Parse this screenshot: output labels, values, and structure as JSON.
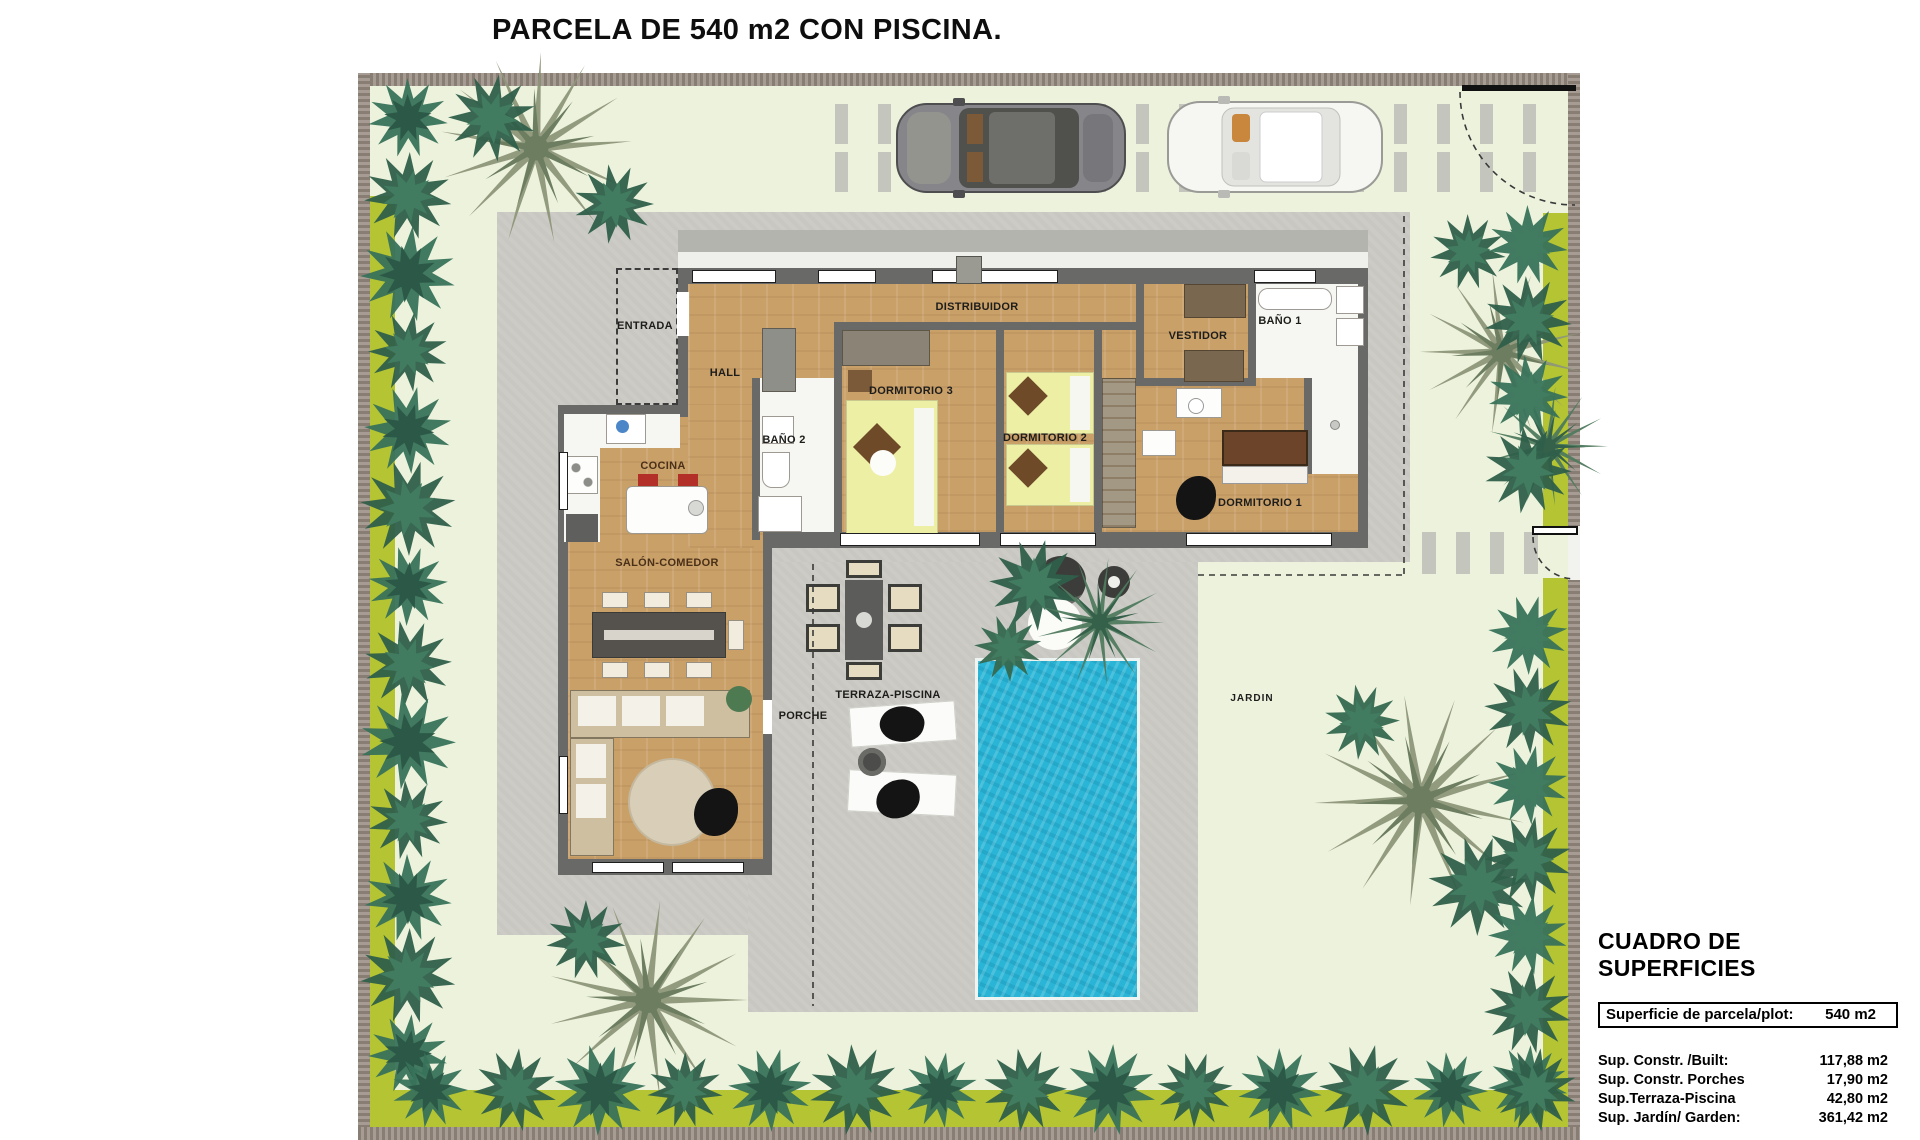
{
  "title": "PARCELA DE 540 m2 CON PISCINA.",
  "rooms": {
    "entrada": "ENTRADA",
    "hall": "HALL",
    "distribuidor": "DISTRIBUIDOR",
    "bano2": "BAÑO 2",
    "dormitorio3": "DORMITORIO 3",
    "dormitorio2": "DORMITORIO 2",
    "dormitorio1": "DORMITORIO 1",
    "vestidor": "VESTIDOR",
    "bano1": "BAÑO 1",
    "cocina": "COCINA",
    "salon": "SALÓN-COMEDOR",
    "porche": "PORCHE",
    "terraza": "TERRAZA-PISCINA",
    "jardin": "JARDIN"
  },
  "summary": {
    "heading": "CUADRO DE SUPERFICIES",
    "plot_row": {
      "label": "Superficie de parcela/plot:",
      "value": "540 m2"
    },
    "rows": [
      {
        "label": "Sup. Constr. /Built:",
        "value": "117,88 m2"
      },
      {
        "label": "Sup. Constr. Porches",
        "value": "17,90 m2"
      },
      {
        "label": "Sup.Terraza-Piscina",
        "value": "42,80 m2"
      },
      {
        "label": "Sup. Jardín/ Garden:",
        "value": "361,42 m2"
      }
    ],
    "total_row": {
      "label": "Sup.Tot.Disfrute/Tot.usable",
      "value": "540 m2"
    }
  },
  "colors": {
    "pool": "#2ab5d6",
    "grass": "#ecf2dc",
    "hedge_lime": "#b5c432",
    "paving": "#cccbc6",
    "perimeter_wall": "#9e948b",
    "wood_floor": "#caa069",
    "bed_yellow": "#edf0a4",
    "stool_red": "#b23028"
  }
}
